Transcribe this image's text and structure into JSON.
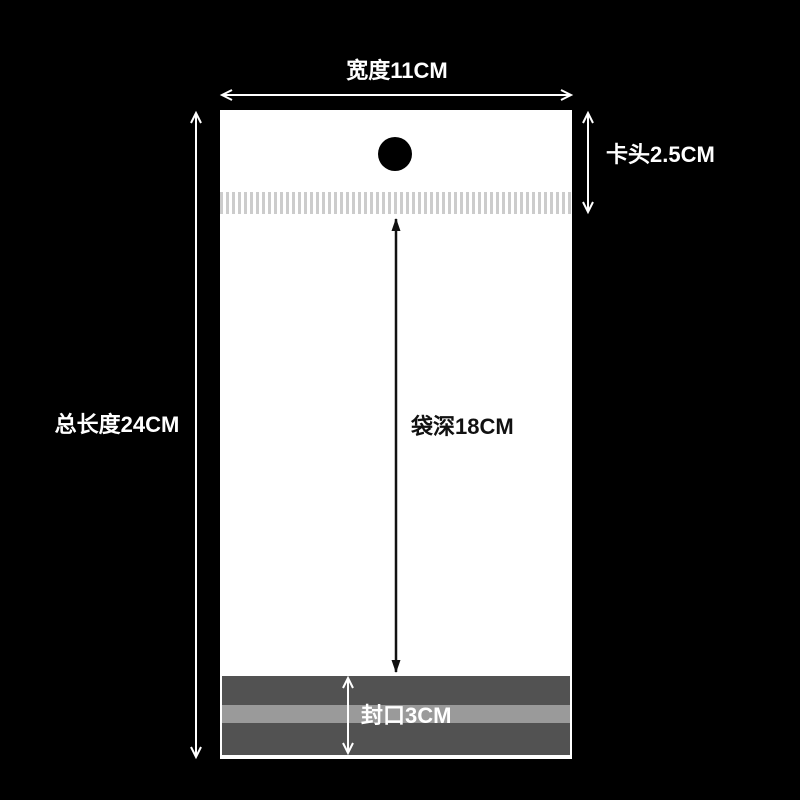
{
  "diagram": {
    "background_color": "#000000",
    "bag": {
      "fill_color": "#ffffff",
      "hole_color": "#000000",
      "tear_stripe_color": "#cccccc",
      "seal_band_color": "#525252",
      "seal_stripe_color": "#9a9a9a"
    },
    "arrow_colors": {
      "light": "#ffffff",
      "dark": "#111111"
    },
    "labels": {
      "width": "宽度11CM",
      "total_length": "总长度24CM",
      "header": "卡头2.5CM",
      "depth": "袋深18CM",
      "seal": "封口3CM"
    },
    "dimensions": [
      {
        "name": "width",
        "label": "宽度11CM",
        "value": 11,
        "unit": "CM"
      },
      {
        "name": "total_length",
        "label": "总长度24CM",
        "value": 24,
        "unit": "CM"
      },
      {
        "name": "header",
        "label": "卡头2.5CM",
        "value": 2.5,
        "unit": "CM"
      },
      {
        "name": "depth",
        "label": "袋深18CM",
        "value": 18,
        "unit": "CM"
      },
      {
        "name": "seal",
        "label": "封口3CM",
        "value": 3,
        "unit": "CM"
      }
    ]
  }
}
